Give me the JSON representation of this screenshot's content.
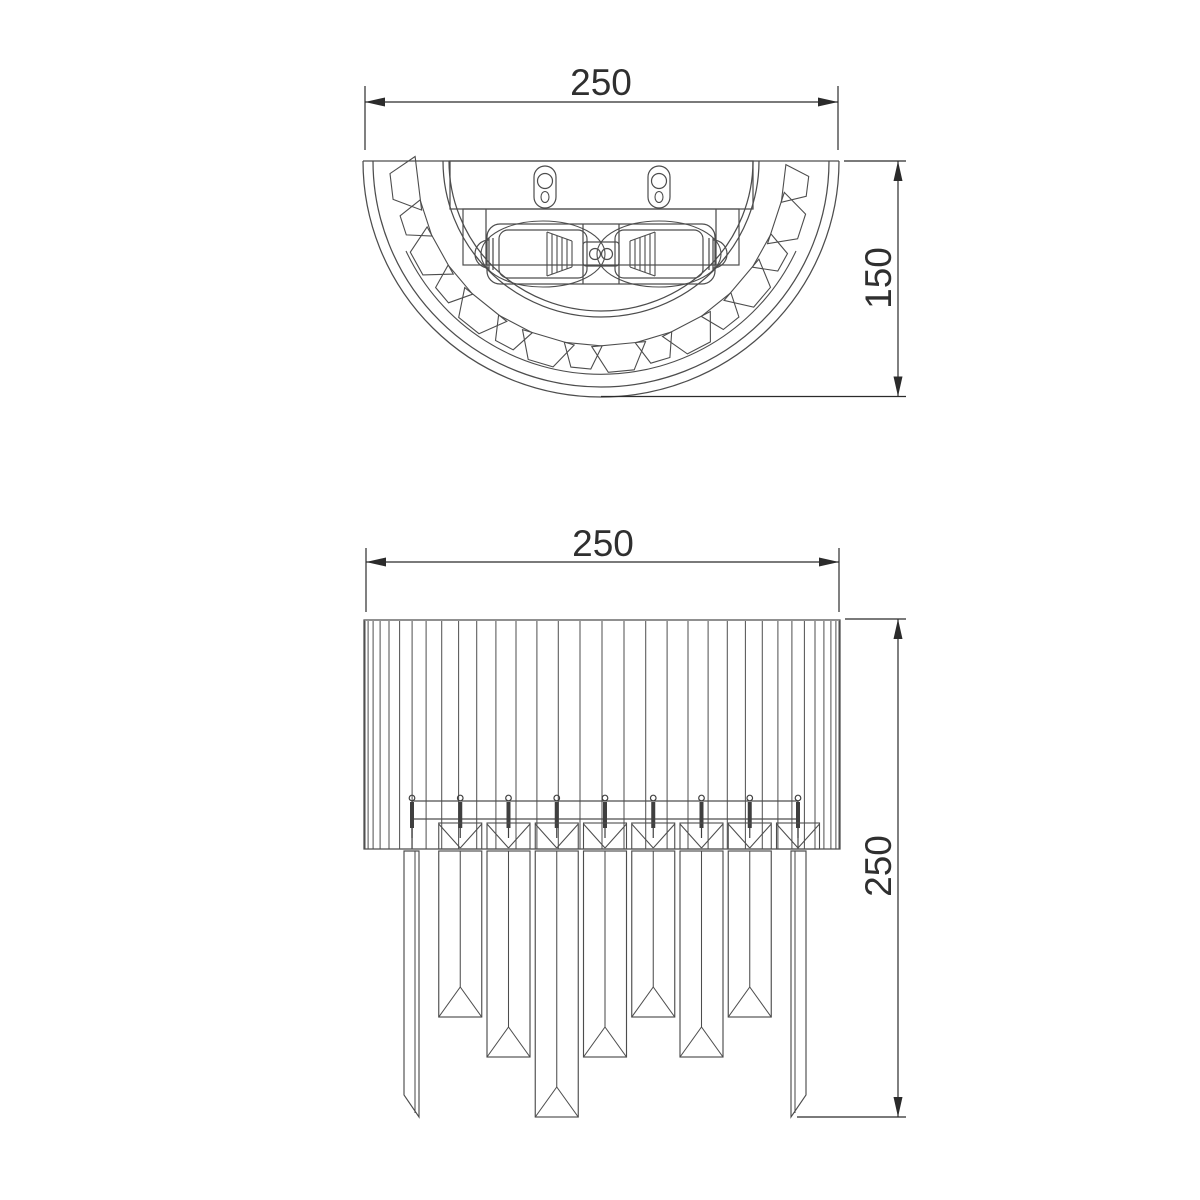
{
  "page": {
    "background": "#ffffff",
    "description": "Technical dimension drawing of a crystal wall sconce: top view and front view"
  },
  "style": {
    "geometry_color": "#4d4d4d",
    "dim_color": "#2b2b2b",
    "text_color": "#2f2f2f"
  },
  "views": {
    "top": {
      "id": "top-view",
      "width_dim": "250",
      "depth_dim": "150"
    },
    "front": {
      "id": "front-view",
      "width_dim": "250",
      "height_dim": "250"
    }
  }
}
